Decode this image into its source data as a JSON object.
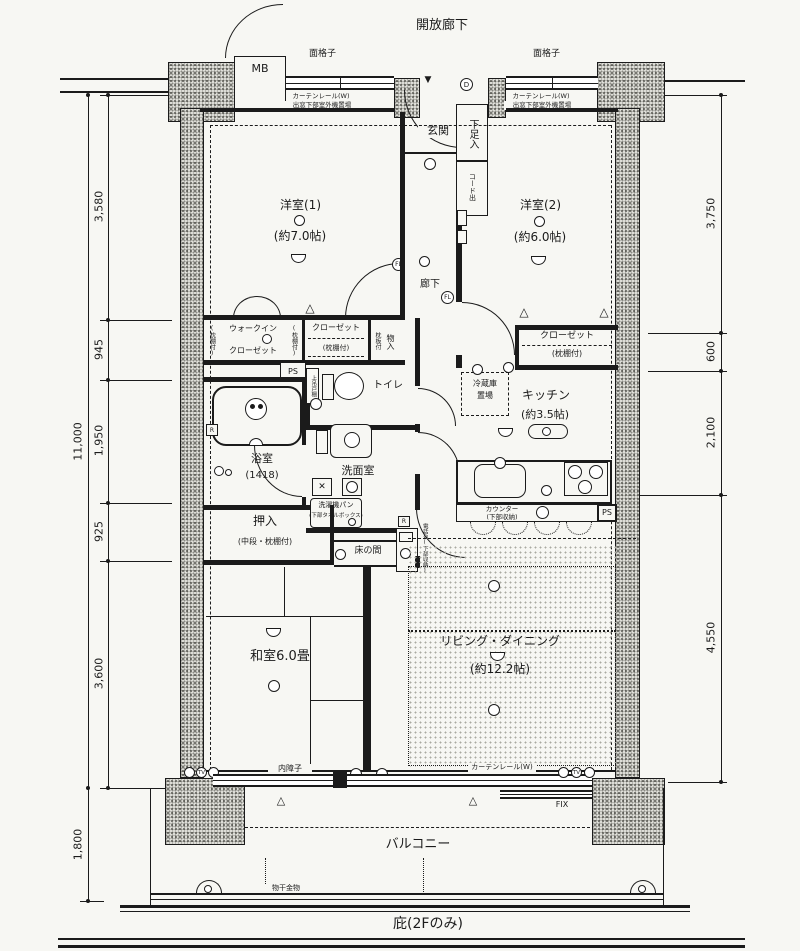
{
  "colors": {
    "ink": "#1b1b1b",
    "paper": "#f7f7f3"
  },
  "labels": {
    "open_corridor": "開放廊下",
    "mb": "MB",
    "grille_left": "面格子",
    "grille_right": "面格子",
    "bay_note_rail_left": "カーテンレール(W)",
    "bay_note_unit_left": "出窓下部室外機置場",
    "bay_note_rail_right": "カーテンレール(W)",
    "bay_note_unit_right": "出窓下部室外機置場",
    "genkan": "玄関",
    "shoebox": "下足入",
    "cord_out": "コード出",
    "room1_name": "洋室(1)",
    "room1_size": "(約7.0帖)",
    "room2_name": "洋室(2)",
    "room2_size": "(約6.0帖)",
    "hallway": "廊下",
    "wic_line1": "ウォークイン",
    "wic_line2": "クローゼット",
    "shelf_note": "(枕棚付)",
    "closet_mid": "クローゼット",
    "monoire": "物入",
    "makuraita": "枕板付",
    "upper_cabinet": "上吊戸棚",
    "toilet": "トイレ",
    "closet2": "クローゼット",
    "bath": "浴室",
    "bath_size": "(1418)",
    "senmen": "洗面室",
    "washer_pan": "洗濯機パン",
    "washer_sub": "(下部タオルボックス)",
    "oshiire": "押入",
    "oshiire_sub": "(中段・枕棚付)",
    "tokonoma": "床の間",
    "tel_stand": "電話台(下部収納)",
    "fridge1": "冷蔵庫",
    "fridge2": "置場",
    "kitchen": "キッチン",
    "kitchen_size": "(約3.5帖)",
    "counter1": "カウンター",
    "counter2": "(下部収納)",
    "washitsu": "和室6.0畳",
    "ld1": "リビング・ダイニング",
    "ld2": "(約12.2帖)",
    "uchishoji": "内障子",
    "curtain_rail_bottom": "カーテンレール(W)",
    "fix": "FIX",
    "balcony": "バルコニー",
    "monohoshi": "物干金物",
    "hisashi": "庇(2Fのみ)"
  },
  "symbols": {
    "door_d": "D",
    "fl": "FL",
    "tv": "TV",
    "r": "R",
    "ps": "PS",
    "triangle": "△",
    "entry_marker": "▼"
  },
  "dimensions": {
    "left_total": "11,000",
    "left_segments": [
      "3,580",
      "945",
      "1,950",
      "925",
      "3,600"
    ],
    "balcony_depth": "1,800",
    "right_segments": [
      "3,750",
      "600",
      "2,100",
      "4,550"
    ]
  }
}
